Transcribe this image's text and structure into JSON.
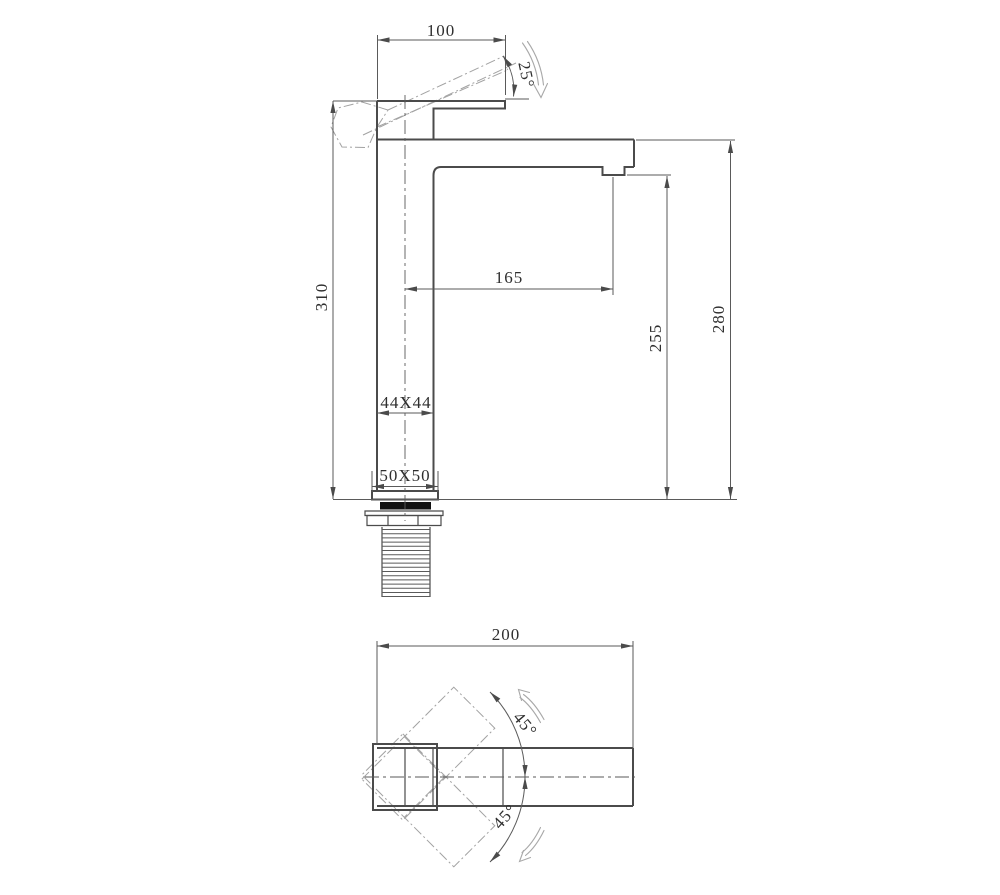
{
  "elevation": {
    "dim_top_width": "100",
    "dim_handle_angle": "25°",
    "dim_total_height": "310",
    "dim_spout_reach": "165",
    "dim_outlet_height": "255",
    "dim_spout_top_height": "280",
    "dim_body_section": "44X44",
    "dim_base_section": "50X50"
  },
  "plan": {
    "dim_overall_length": "200",
    "dim_swing_up": "45°",
    "dim_swing_down": "45°"
  },
  "colors": {
    "background": "#ffffff",
    "object_line": "#4b4b4b",
    "thin_line": "#5a5a5a",
    "phantom_line": "#a2a2a2",
    "text": "#2f2f2f",
    "seal_fill": "#111111",
    "swing_arrow": "#a8a8a8"
  }
}
